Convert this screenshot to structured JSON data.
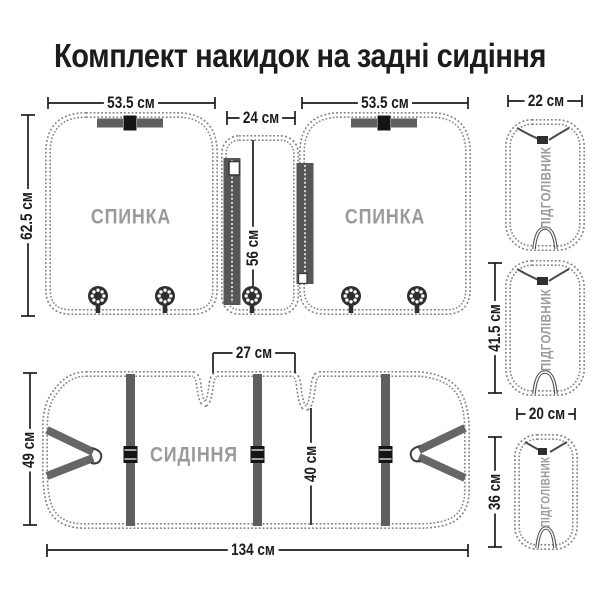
{
  "title": "Комплект накидок на задні сидіння",
  "units": "см",
  "labels": {
    "backrest": "СПИНКА",
    "seat": "СИДІННЯ",
    "headrest": "ПІДГОЛІВНИК"
  },
  "dims": {
    "backrest_left_width": "53.5 см",
    "backrest_right_width": "53.5 см",
    "backrest_left_height": "62.5 см",
    "center_panel_width": "24 см",
    "center_panel_height": "56 см",
    "headrest_top_width": "22 см",
    "headrest_mid_height": "41.5 см",
    "headrest_small_width": "20 см",
    "headrest_small_height": "36 см",
    "seat_gap_width": "27 см",
    "seat_side_height": "49 см",
    "seat_mid_height": "40 см",
    "seat_total_width": "134 см"
  },
  "colors": {
    "text": "#1c1c1c",
    "muted_label": "#9a9a9a",
    "stitch": "#858585",
    "strap": "#5f5f5f",
    "buckle": "#141414",
    "background": "#ffffff"
  }
}
